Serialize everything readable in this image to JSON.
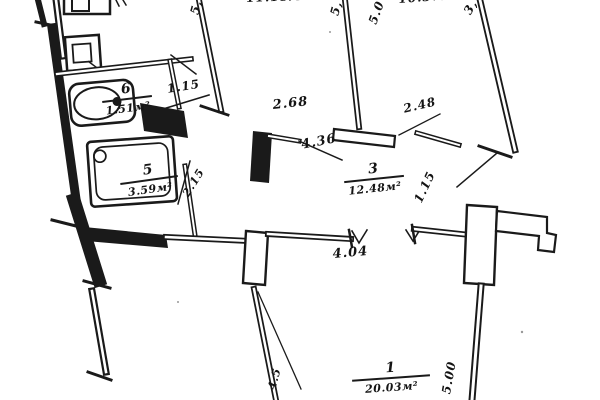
{
  "document": {
    "kind": "scanned apartment floor plan",
    "ink_color": "#1a1a1a",
    "paper_color": "#ffffff"
  },
  "rooms": {
    "room1": {
      "number": "1",
      "area": "20.03м²"
    },
    "room3": {
      "number": "3",
      "area": "12.48м²"
    },
    "room5": {
      "number": "5",
      "area": "3.59м²"
    },
    "room6": {
      "number": "6",
      "area": "1.51м²"
    },
    "room2_area_clipped": "11.18м²",
    "room4_area_clipped": "10.37м²"
  },
  "dimensions": {
    "wc_door": "1.15",
    "room2_door": "2.68",
    "hall_width": "4.36",
    "room4_door": "2.48",
    "room4_jamb": "1.15",
    "hall_opening": "4.04",
    "bath_door": "2.15",
    "room1_depth": "5.00",
    "room1_side": "4.5",
    "edge_frag_a": "5,",
    "edge_frag_b": "5,",
    "edge_frag_c": "5.0",
    "edge_frag_d": "3,"
  },
  "icons": {
    "toilet": "toilet-icon",
    "bathtub": "bathtub-icon",
    "stove": "stove-icon",
    "sink": "sink-icon"
  }
}
